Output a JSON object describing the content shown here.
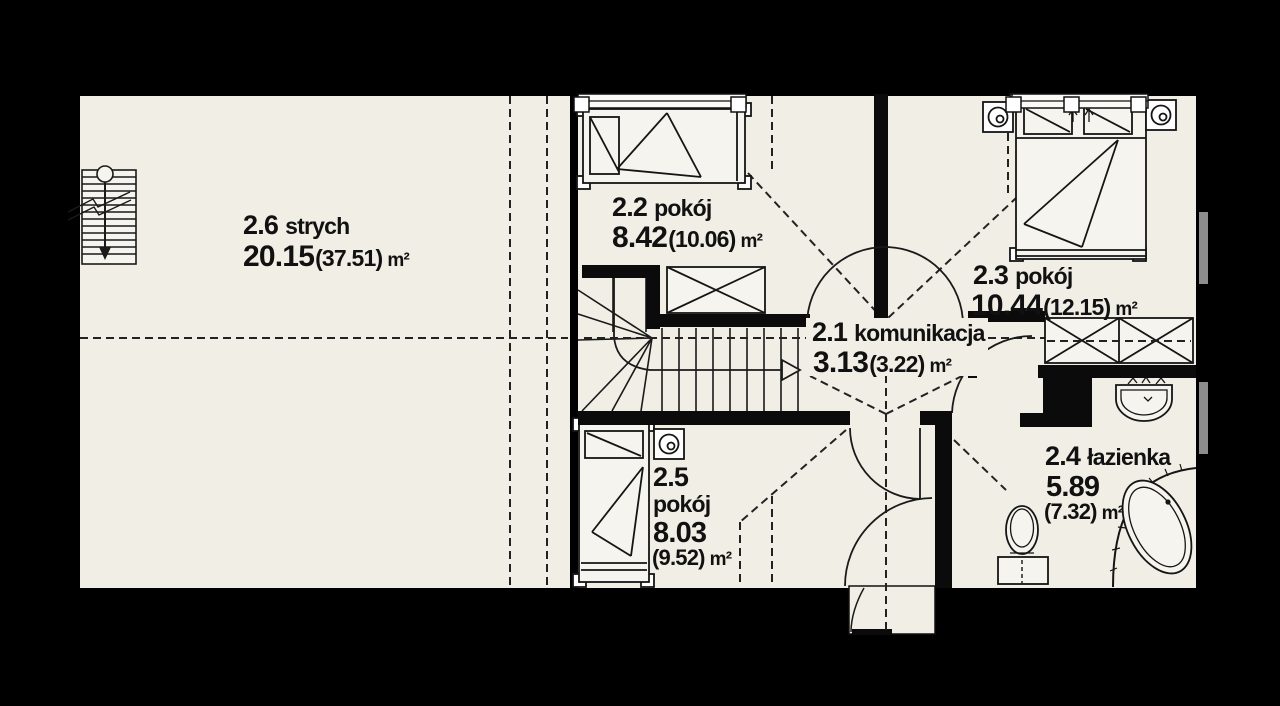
{
  "plan": {
    "language": "pl",
    "rooms": [
      {
        "id": "2.6",
        "name": "strych",
        "area": "20.15",
        "area_alt": "(37.51)",
        "unit": "m²"
      },
      {
        "id": "2.2",
        "name": "pokój",
        "area": "8.42",
        "area_alt": "(10.06)",
        "unit": "m²"
      },
      {
        "id": "2.3",
        "name": "pokój",
        "area": "10.44",
        "area_alt": "(12.15)",
        "unit": "m²"
      },
      {
        "id": "2.1",
        "name": "komunikacja",
        "area": "3.13",
        "area_alt": "(3.22)",
        "unit": "m²"
      },
      {
        "id": "2.5",
        "name": "pokój",
        "area": "8.03",
        "area_alt": "(9.52)",
        "unit": "m²"
      },
      {
        "id": "2.4",
        "name": "łazienka",
        "area": "5.89",
        "area_alt": "(7.32)",
        "unit": "m²"
      }
    ],
    "colors": {
      "background": "#000000",
      "floor": "#f1eee6",
      "wall": "#0b0b0b",
      "line": "#1a1a1a",
      "dashed_line": "#222222",
      "roof_window_gray": "#8d8d8d"
    },
    "fixtures": [
      "stairs-icon",
      "single-bed-icon",
      "double-bed-icon",
      "wardrobe-icon",
      "ceiling-lamp-icon",
      "washbasin-icon",
      "toilet-icon",
      "corner-bathtub-icon",
      "door-swing-icon",
      "window-icon",
      "roof-window-icon",
      "attic-ladder-icon"
    ]
  }
}
